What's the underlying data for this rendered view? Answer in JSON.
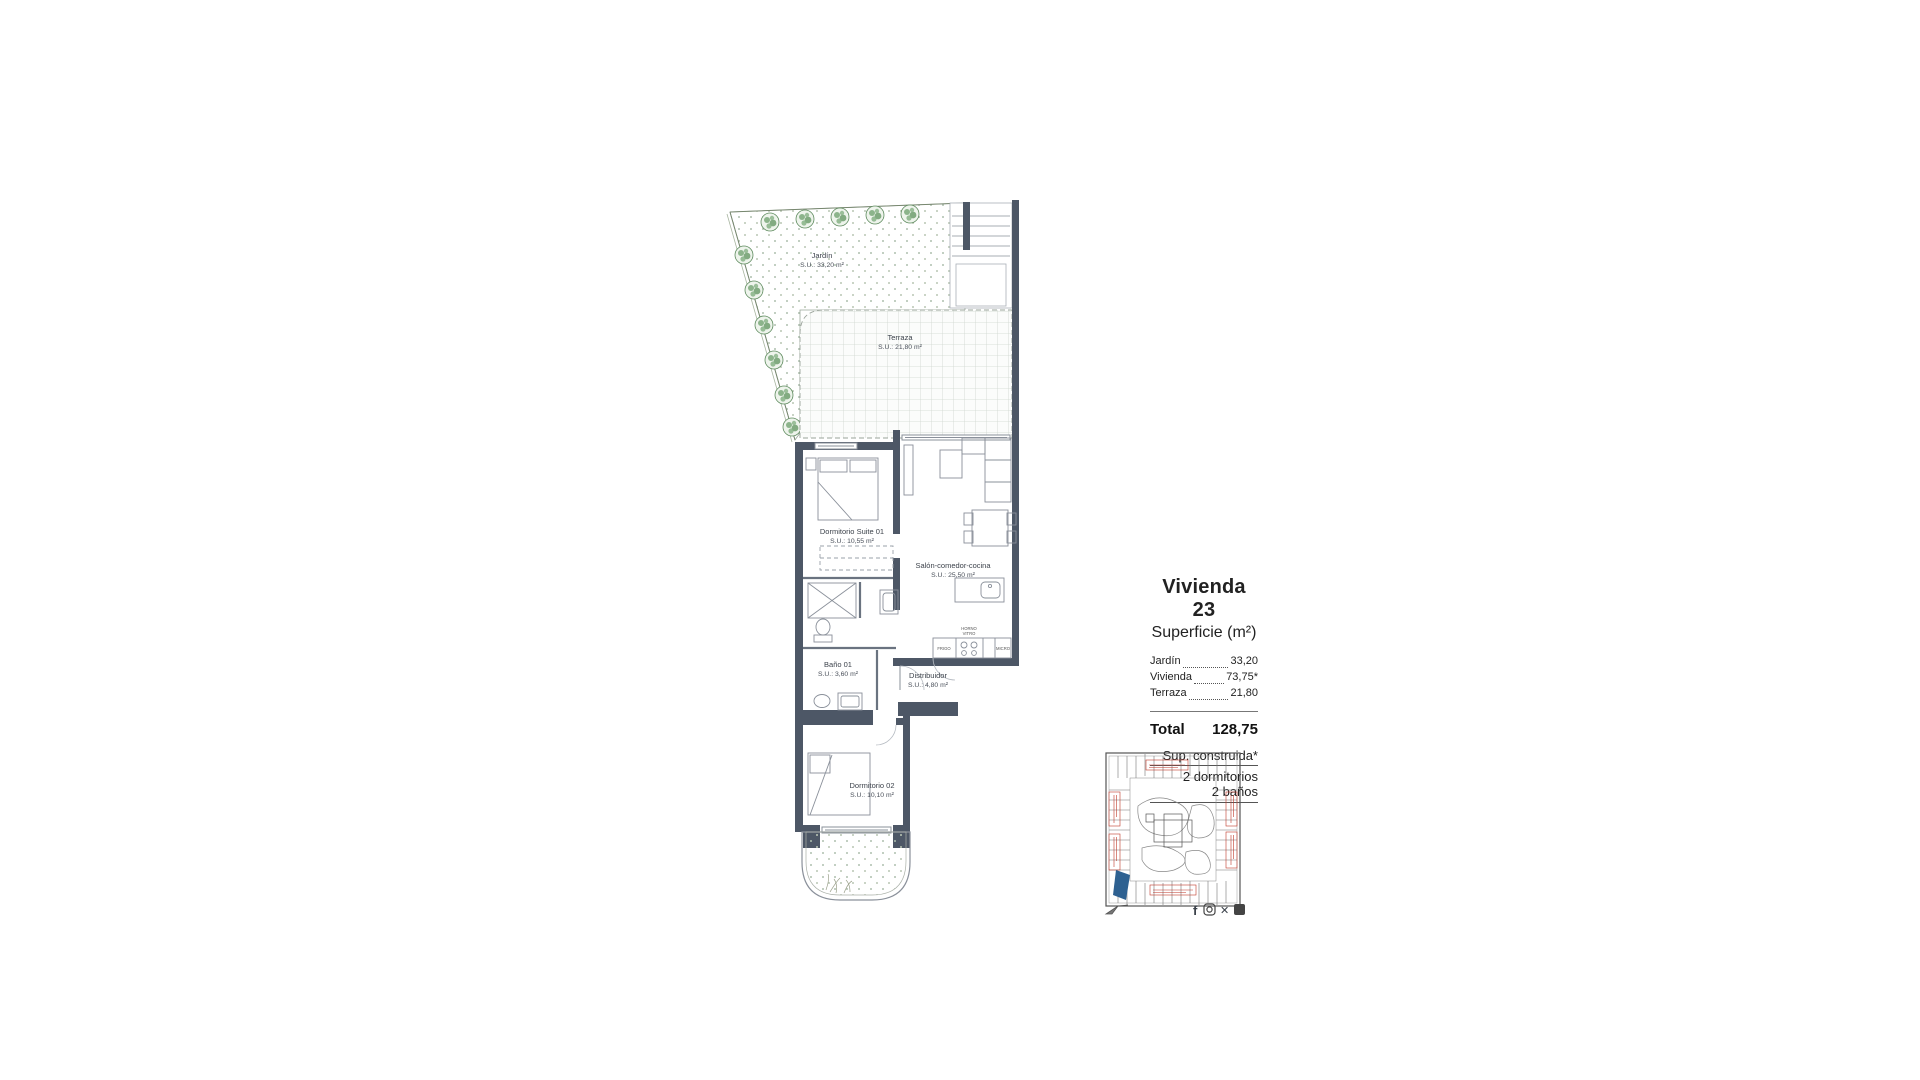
{
  "plan": {
    "garden": {
      "name": "Jardín",
      "area": "S.U.: 33,20 m²"
    },
    "terrace": {
      "name": "Terraza",
      "area": "S.U.: 21,80 m²"
    },
    "rooms": {
      "suite": {
        "name": "Dormitorio Suite 01",
        "area": "S.U.: 10,55 m²"
      },
      "salon": {
        "name": "Salón-comedor-cocina",
        "area": "S.U.: 25,50 m²"
      },
      "bano1": {
        "name": "Baño 01",
        "area": "S.U.: 3,60 m²"
      },
      "distribuidor": {
        "name": "Distribuidor",
        "area": "S.U.: 4,80 m²"
      },
      "dorm2": {
        "name": "Dormitorio 02",
        "area": "S.U.: 10,10 m²"
      }
    },
    "kitchen_labels": {
      "fridge": "FRIGO",
      "oven_line1": "HORNO",
      "oven_line2": "VITRO",
      "micro": "MICRO"
    }
  },
  "info": {
    "title": "Vivienda 23",
    "subtitle": "Superficie (m²)",
    "items": [
      {
        "label": "Jardín",
        "value": "33,20"
      },
      {
        "label": "Vivienda",
        "value": "73,75*"
      },
      {
        "label": "Terraza",
        "value": "21,80"
      }
    ],
    "total_label": "Total",
    "total_value": "128,75",
    "notes": [
      "Sup. construida*",
      "2 dormitorios",
      "2 baños"
    ]
  },
  "social": {
    "facebook_glyph": "f",
    "x_glyph": "✕"
  },
  "colors": {
    "wall": "#4d5766",
    "thin_wall": "#6a7380",
    "furniture": "#8a909a",
    "terrace_grid": "#cfd6cf",
    "garden_dot": "#aebfae",
    "tree": "#6f9e6f",
    "keyplan_red": "#c0392b",
    "keyplan_blue": "#2e6191"
  }
}
